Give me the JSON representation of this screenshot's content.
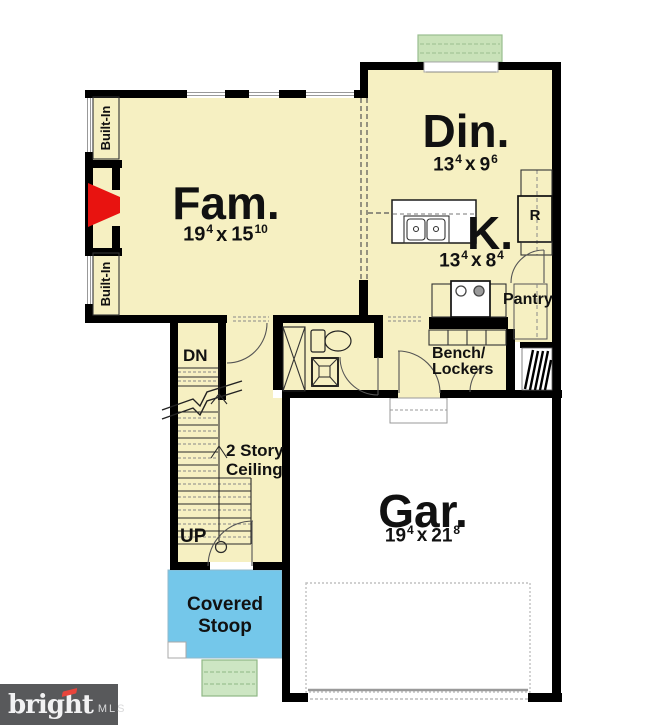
{
  "rooms": {
    "family": {
      "name": "Fam.",
      "dims": {
        "a": "19",
        "a_sup": "4",
        "sep": "x",
        "b": "15",
        "b_sup": "10"
      }
    },
    "dining": {
      "name": "Din.",
      "dims": {
        "a": "13",
        "a_sup": "4",
        "sep": "x",
        "b": "9",
        "b_sup": "6"
      }
    },
    "kitchen": {
      "name": "K.",
      "dims": {
        "a": "13",
        "a_sup": "4",
        "sep": "x",
        "b": "8",
        "b_sup": "4"
      }
    },
    "garage": {
      "name": "Gar.",
      "dims": {
        "a": "19",
        "a_sup": "4",
        "sep": "x",
        "b": "21",
        "b_sup": "8"
      }
    }
  },
  "labels": {
    "built_in": "Built-In",
    "pantry": "Pantry",
    "bench": "Bench/",
    "lockers": "Lockers",
    "dn": "DN",
    "up": "UP",
    "two_story": "2 Story",
    "ceiling": "Ceiling",
    "covered": "Covered",
    "stoop": "Stoop",
    "refrigerator": "R"
  },
  "watermark": {
    "brand": "bright",
    "suffix": "MLS"
  },
  "colors": {
    "room_fill": "#F6F0C2",
    "wall": "#000000",
    "stoop_blue": "#74C7EA",
    "steps_green": "#CDE6C3",
    "back_stoop_green": "#C9E2B9",
    "fireplace_red": "#E81310",
    "garage_fill": "#FFFFFF",
    "watermark_bg": "#58595B",
    "watermark_text": "#F2F2F3",
    "watermark_accent": "#E8453C"
  }
}
